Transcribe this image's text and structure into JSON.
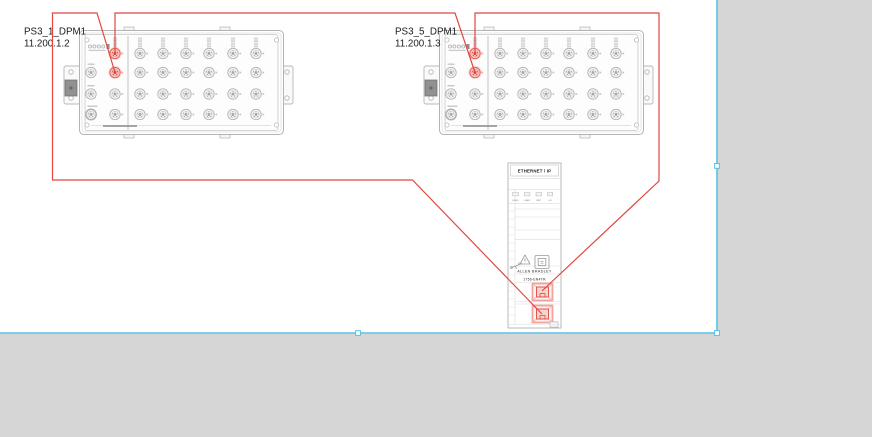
{
  "page": {
    "background_color": "#d6d6d6",
    "canvas_color": "#ffffff",
    "selection_color": "#58c2e8"
  },
  "devices": [
    {
      "name": "PS3_1_DPM1",
      "ip": "11.200.1.2"
    },
    {
      "name": "PS3_5_DPM1",
      "ip": "11.200.1.3"
    }
  ],
  "module": {
    "header": "ETHERNET / IP",
    "led_labels": [
      "LINK1",
      "LINK2",
      "NET",
      "OK"
    ],
    "brand": "ALLEN BRADLEY",
    "model": "1756-EN4TR"
  },
  "wire_color": "#e2483d",
  "port_highlight_color": "#f2a39d"
}
